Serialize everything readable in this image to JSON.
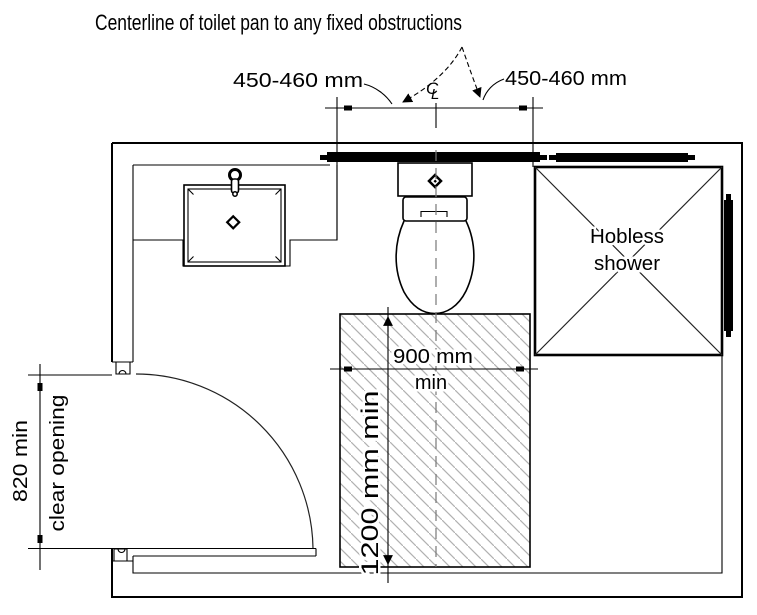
{
  "header": {
    "title": "Centerline of toilet pan to any fixed obstructions"
  },
  "dims": {
    "top_left": {
      "label": "450-460 mm"
    },
    "top_right": {
      "label": "450-460 mm"
    },
    "clearance_width": {
      "line1": "900 mm",
      "line2": "min"
    },
    "clearance_depth": {
      "label": "1200 mm min"
    },
    "door": {
      "line1": "820 min",
      "line2": "clear opening"
    }
  },
  "fixtures": {
    "shower": {
      "line1": "Hobless",
      "line2": "shower"
    }
  },
  "symbols": {
    "centerline": {
      "c": "C",
      "l": "L"
    }
  },
  "colors": {
    "line": "#000000",
    "hatch": "#b0b0b0",
    "background": "#ffffff",
    "text": "#000000"
  }
}
